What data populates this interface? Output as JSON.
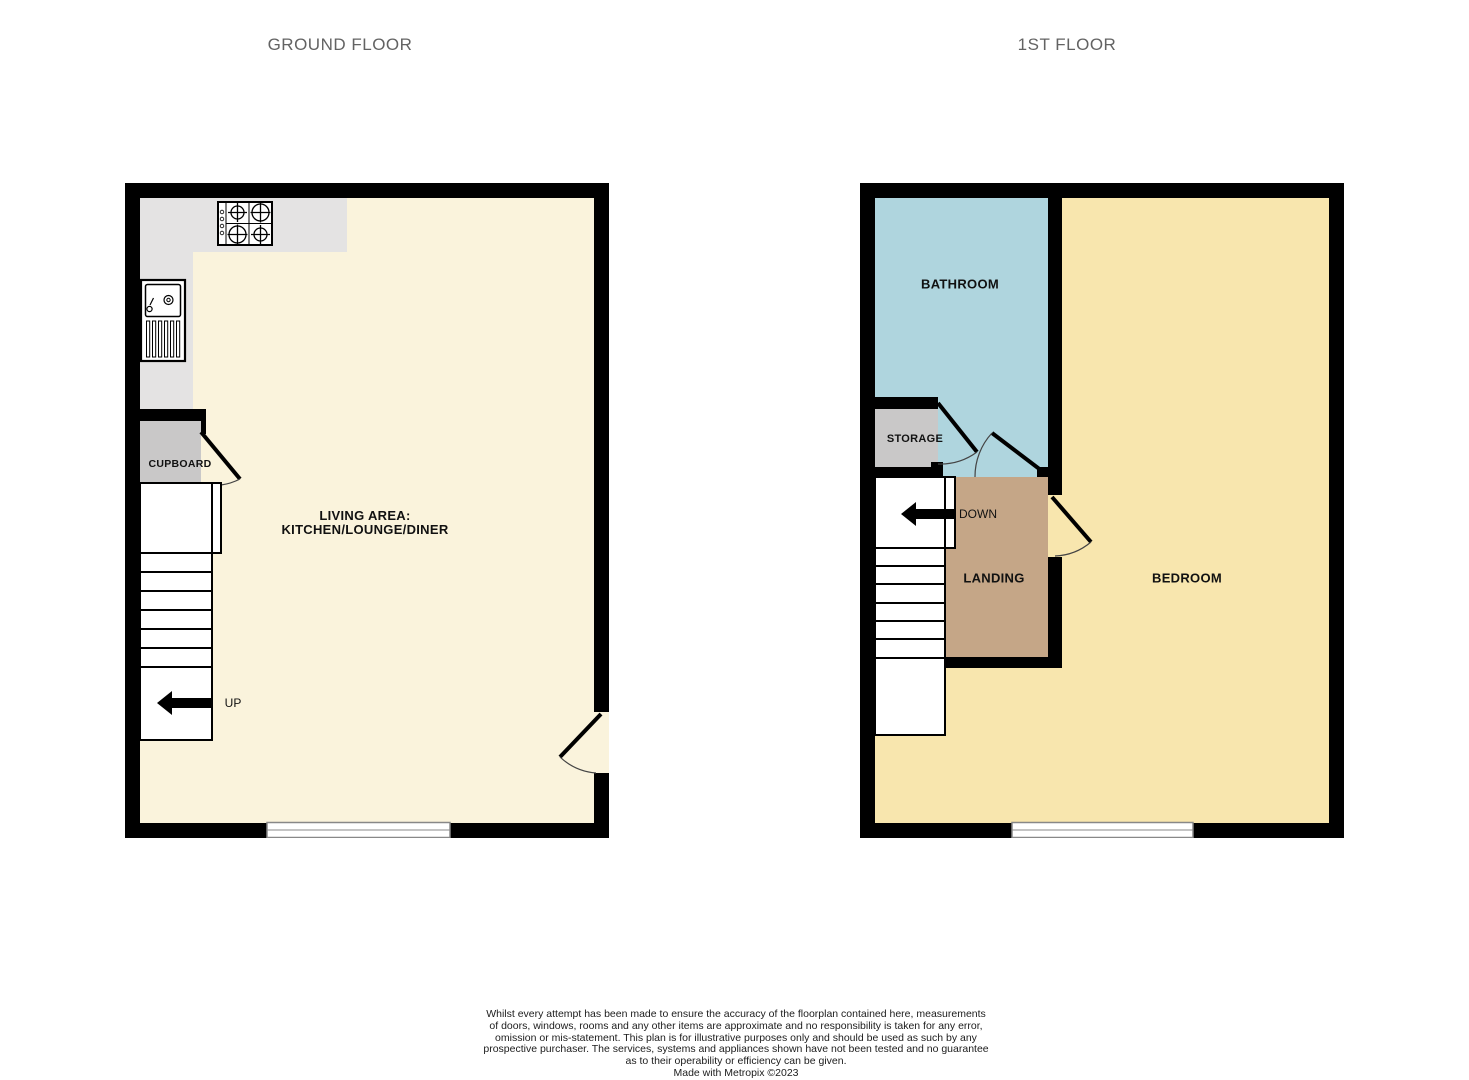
{
  "titles": {
    "ground_floor": "GROUND FLOOR",
    "first_floor": "1ST FLOOR"
  },
  "ground_floor": {
    "living_area_label_line1": "LIVING AREA:",
    "living_area_label_line2": "KITCHEN/LOUNGE/DINER",
    "cupboard_label": "CUPBOARD",
    "up_label": "UP"
  },
  "first_floor": {
    "bathroom_label": "BATHROOM",
    "storage_label": "STORAGE",
    "landing_label": "LANDING",
    "bedroom_label": "BEDROOM",
    "down_label": "DOWN"
  },
  "colors": {
    "wall": "#000000",
    "living_area": "#faf3dc",
    "kitchen_counter": "#e4e3e3",
    "cupboard": "#c9c8c8",
    "bathroom": "#afd5de",
    "bedroom": "#f8e6ae",
    "landing": "#c5a687",
    "storage": "#c9c8c8",
    "title_text": "#636363"
  },
  "disclaimer": {
    "lines": [
      "Whilst every attempt has been made to ensure the accuracy of the floorplan contained here, measurements",
      "of doors, windows, rooms and any other items are approximate and no responsibility is taken for any error,",
      "omission or mis-statement. This plan is for illustrative purposes only and should be used as such by any",
      "prospective purchaser. The services, systems and appliances shown have not been tested and no guarantee",
      "as to their operability or efficiency can be given."
    ],
    "made_with": "Made with Metropix ©2023"
  }
}
